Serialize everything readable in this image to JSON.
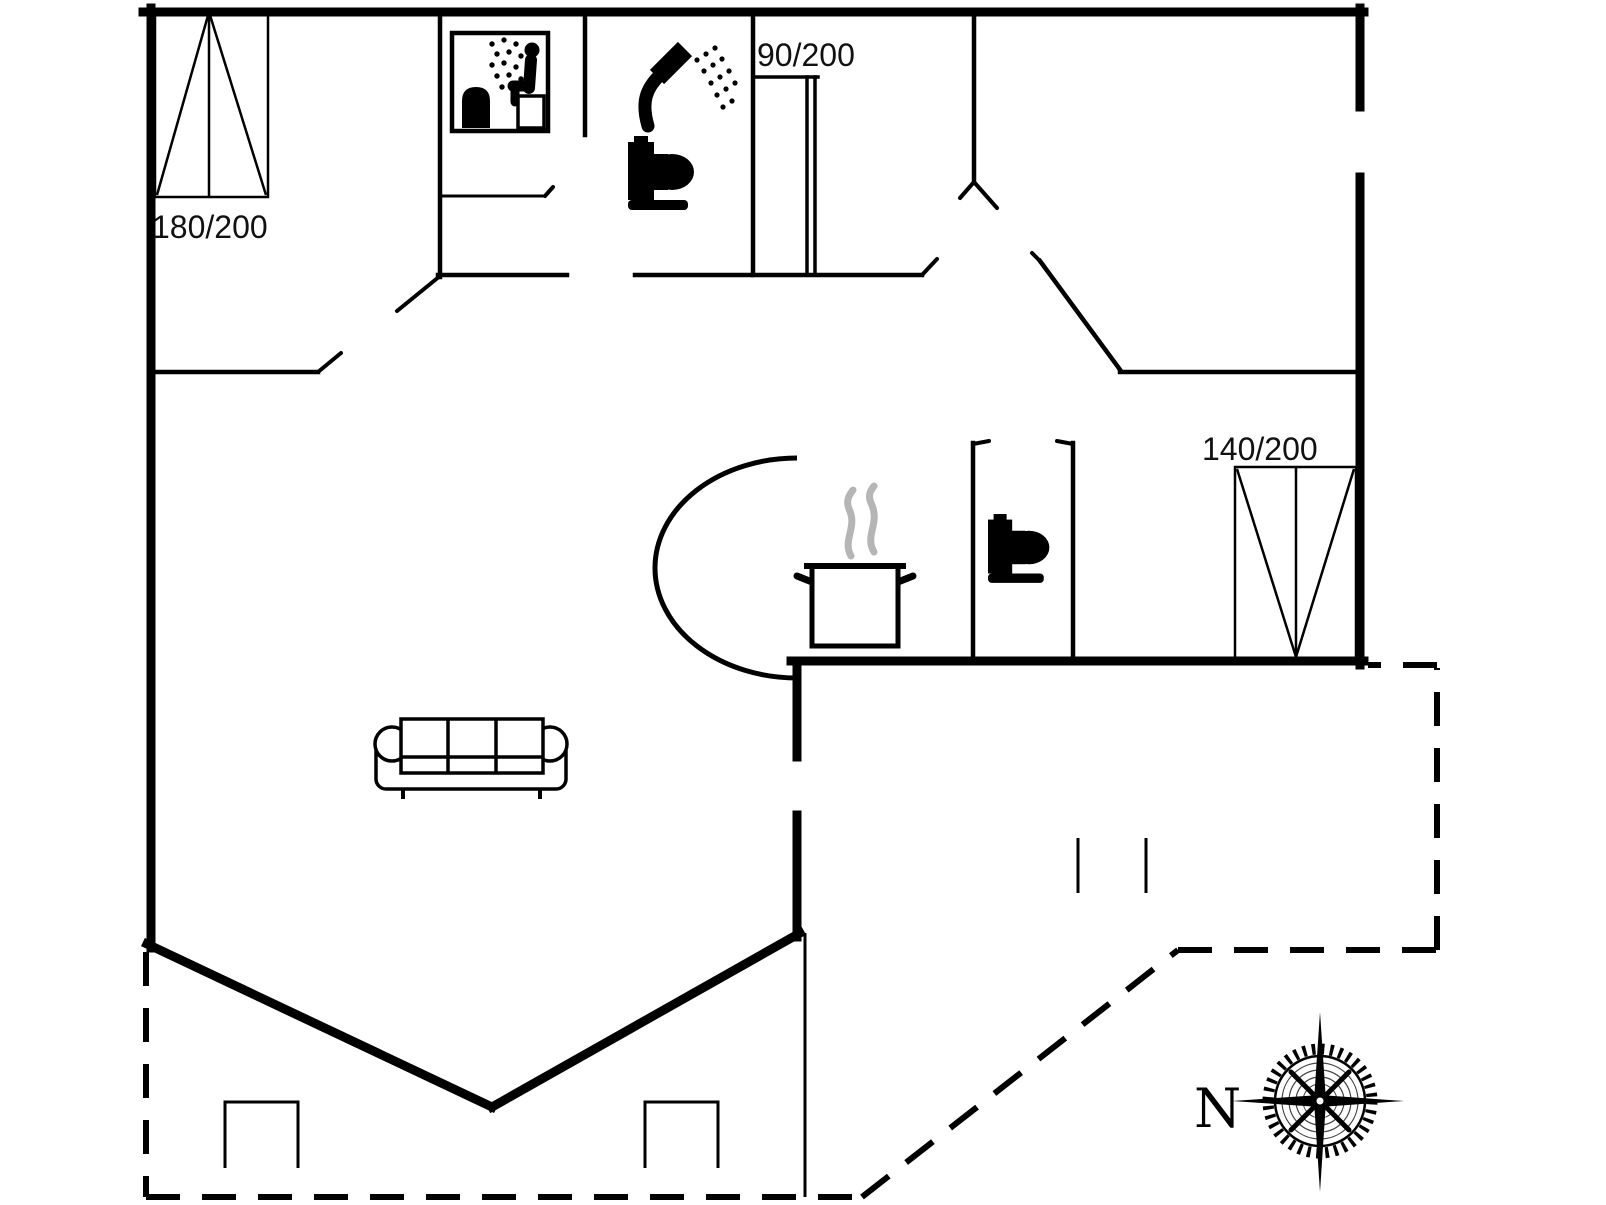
{
  "document": {
    "type": "floor-plan"
  },
  "colors": {
    "line": "#000000",
    "label": "#111111",
    "steam": "#b5b5b5",
    "background": "#ffffff"
  },
  "labels": {
    "window_top_left": "180/200",
    "hall_door": "90/200",
    "window_bottom_right": "140/200",
    "compass_north": "N"
  },
  "icons": [
    {
      "name": "sauna-icon"
    },
    {
      "name": "shower-icon"
    },
    {
      "name": "toilet-icon"
    },
    {
      "name": "toilet-icon-2"
    },
    {
      "name": "cooking-pot-icon"
    },
    {
      "name": "sofa-icon"
    },
    {
      "name": "compass-rose-icon"
    }
  ],
  "plan": {
    "walls_thick": [
      [
        143,
        12,
        1364,
        12
      ],
      [
        151,
        8,
        151,
        948
      ],
      [
        1360,
        8,
        1360,
        107
      ],
      [
        1360,
        177,
        1360,
        665
      ],
      [
        791,
        661,
        1364,
        661
      ],
      [
        797,
        661,
        797,
        757
      ],
      [
        797,
        815,
        797,
        937
      ],
      [
        147,
        944,
        492,
        1107
      ],
      [
        492,
        1107,
        800,
        933
      ]
    ],
    "walls_medium": [
      [
        440,
        10,
        440,
        277
      ],
      [
        438,
        275,
        567,
        275
      ],
      [
        635,
        275,
        922,
        275
      ],
      [
        585,
        10,
        585,
        135
      ],
      [
        753,
        10,
        753,
        275
      ],
      [
        974,
        10,
        974,
        182
      ],
      [
        149,
        372,
        318,
        372
      ],
      [
        1120,
        372,
        1362,
        372
      ],
      [
        973,
        443,
        973,
        659
      ],
      [
        1073,
        443,
        1073,
        659
      ],
      [
        1040,
        261,
        1121,
        371
      ]
    ],
    "door_lines": [
      [
        753,
        77,
        818,
        77
      ],
      [
        807,
        77,
        807,
        273
      ],
      [
        815,
        77,
        815,
        273
      ]
    ],
    "ticks": [
      [
        318,
        372,
        341,
        353
      ],
      [
        440,
        276,
        397,
        311
      ],
      [
        922,
        275,
        937,
        259
      ],
      [
        545,
        196,
        553,
        187
      ],
      [
        1040,
        261,
        1032,
        253
      ],
      [
        974,
        182,
        960,
        198
      ],
      [
        974,
        182,
        997,
        208
      ],
      [
        973,
        444,
        989,
        441
      ],
      [
        1057,
        441,
        1073,
        444
      ]
    ],
    "lines_thin": [
      [
        440,
        196,
        545,
        196
      ],
      [
        805,
        933,
        805,
        1197
      ],
      [
        1078,
        838,
        1078,
        893
      ],
      [
        1146,
        838,
        1146,
        893
      ]
    ],
    "dashed": [
      [
        146,
        952,
        146,
        1197
      ],
      [
        146,
        1197,
        862,
        1197
      ],
      [
        862,
        1197,
        1178,
        950
      ],
      [
        1178,
        950,
        1437,
        950
      ],
      [
        1437,
        950,
        1437,
        668
      ],
      [
        1437,
        665,
        1368,
        665
      ]
    ],
    "windows": [
      {
        "name": "window-180x200",
        "rect": [
          155,
          10,
          113,
          187
        ],
        "divider": [
          209,
          10,
          209,
          197
        ],
        "diagonals": [
          [
            157,
            195,
            209,
            12
          ],
          [
            266,
            195,
            209,
            12
          ]
        ]
      },
      {
        "name": "window-140x200",
        "rect": [
          1235,
          467,
          121,
          192
        ],
        "divider": [
          1296,
          467,
          1296,
          659
        ],
        "diagonals": [
          [
            1237,
            469,
            1296,
            657
          ],
          [
            1354,
            469,
            1296,
            657
          ]
        ]
      }
    ],
    "paths": [
      {
        "name": "kitchen-door-arc",
        "d": "M 797 458 A 142 110 0 0 0 797 678",
        "cls": "arc"
      },
      {
        "name": "terrace-post-left",
        "d": "M225,1168 L225,1102 L298,1102 L298,1168",
        "cls": "lt"
      },
      {
        "name": "terrace-post-right",
        "d": "M645,1168 L645,1102 L718,1102 L718,1168",
        "cls": "lt"
      }
    ]
  }
}
